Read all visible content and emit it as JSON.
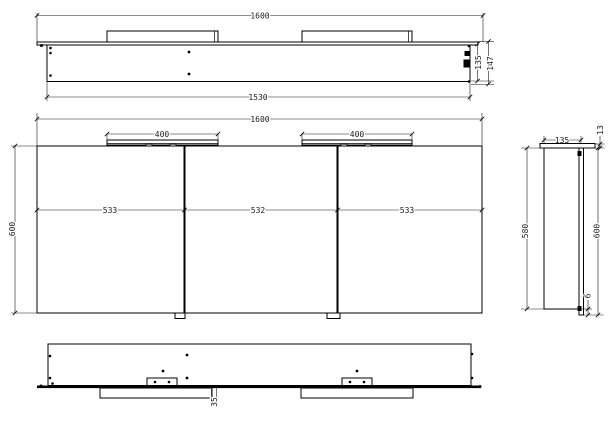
{
  "colors": {
    "background": "#ffffff",
    "line": "#000000",
    "text": "#1a1a1a"
  },
  "top_view": {
    "overall_width": "1600",
    "carcass_width": "1530",
    "carcass_depth": "135",
    "total_depth": "147"
  },
  "front_view": {
    "overall_width": "1600",
    "left_light_width": "400",
    "right_light_width": "400",
    "door_widths": [
      "533",
      "532",
      "533"
    ],
    "height": "600"
  },
  "side_view": {
    "depth": "135",
    "top_panel_detail": "13",
    "carcass_height": "580",
    "total_height": "600",
    "bottom_overhang": "6"
  },
  "bottom_view": {
    "detail_offset": "35"
  }
}
